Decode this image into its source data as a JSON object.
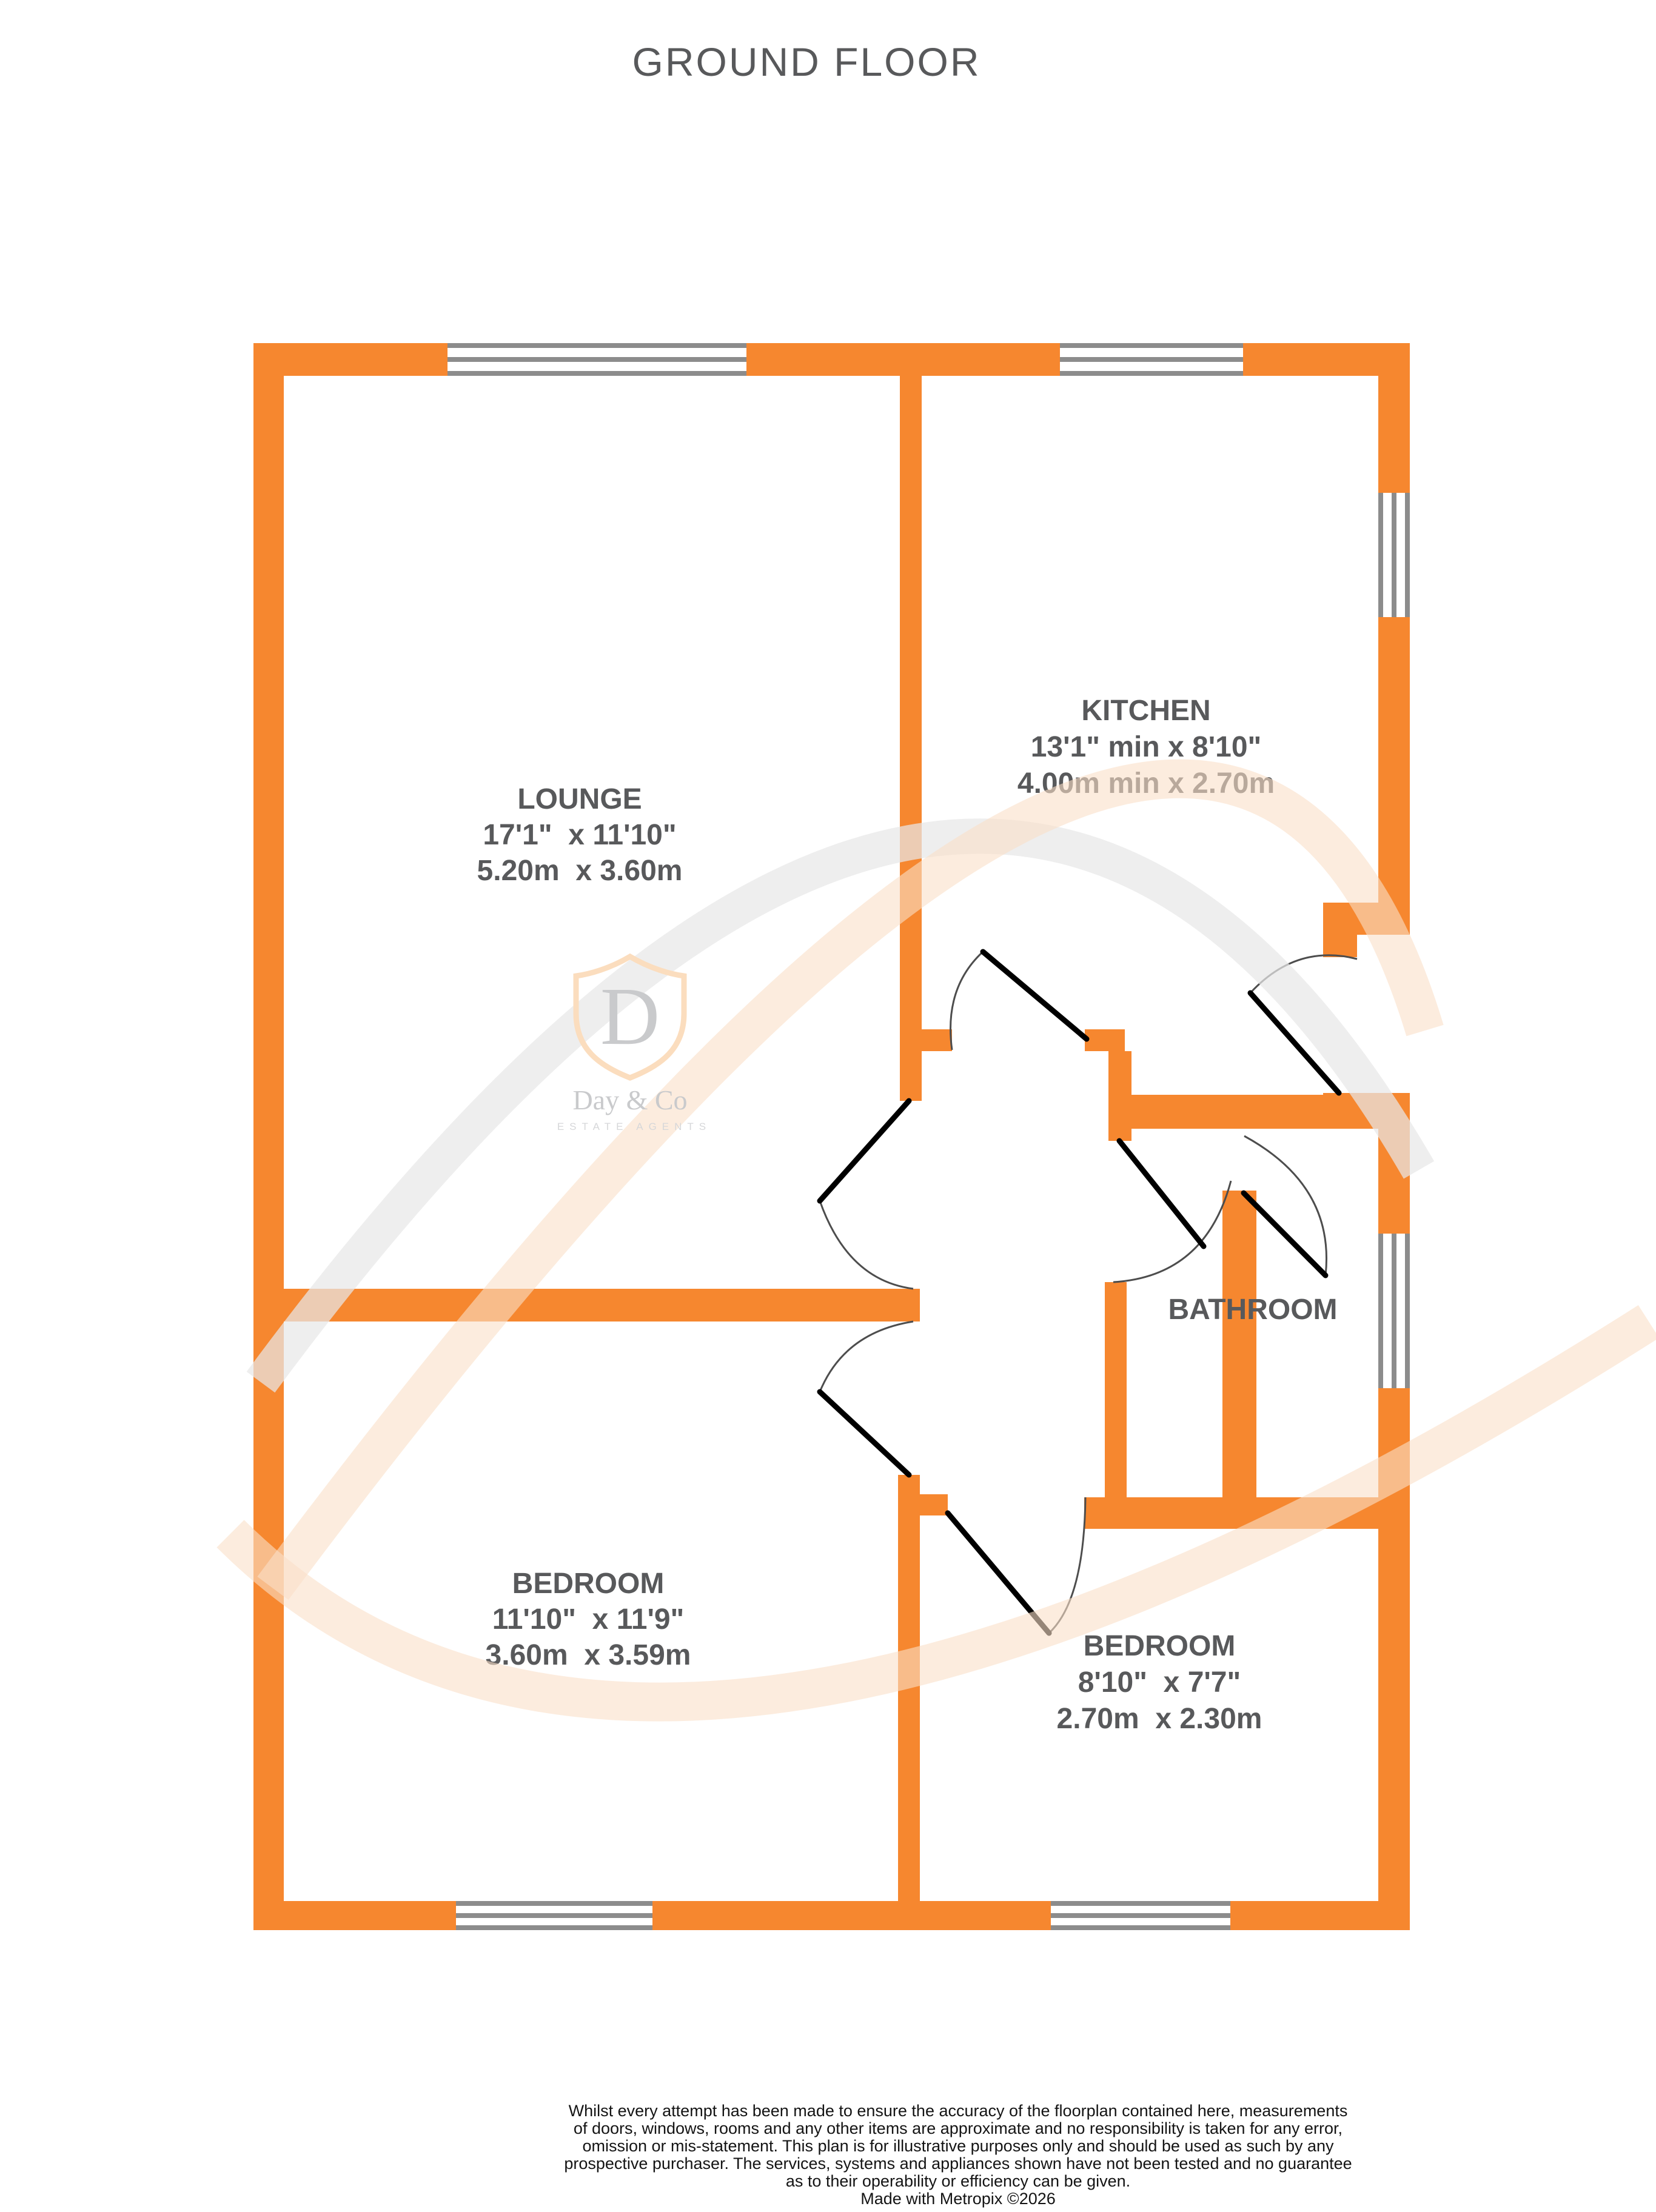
{
  "title": "GROUND FLOOR",
  "floor_plan": {
    "rooms": {
      "lounge": {
        "name": "LOUNGE",
        "imperial": "17'1\"  x 11'10\"",
        "metric": "5.20m  x 3.60m"
      },
      "kitchen": {
        "name": "KITCHEN",
        "imperial": "13'1\" min x 8'10\"",
        "metric": "4.00m min x 2.70m"
      },
      "bathroom": {
        "name": "BATHROOM",
        "imperial": "",
        "metric": ""
      },
      "bedroom1": {
        "name": "BEDROOM",
        "imperial": "11'10\"  x 11'9\"",
        "metric": "3.60m  x 3.59m"
      },
      "bedroom2": {
        "name": "BEDROOM",
        "imperial": "8'10\"  x 7'7\"",
        "metric": "2.70m  x 2.30m"
      }
    },
    "features": {
      "windows": [
        "lounge-front-window",
        "kitchen-front-window",
        "kitchen-side-window",
        "bathroom-side-window",
        "bedroom1-rear-window",
        "bedroom2-rear-window"
      ],
      "doors": [
        "lounge-door",
        "kitchen-door",
        "bedroom1-door",
        "bedroom2-door",
        "bathroom-door",
        "side-entrance-door"
      ]
    }
  },
  "watermark": {
    "initial": "D",
    "name": "Day & Co",
    "tagline": "ESTATE AGENTS"
  },
  "disclaimer": {
    "lines": [
      "Whilst every attempt has been made to ensure the accuracy of the floorplan contained here, measurements",
      "of doors, windows, rooms and any other items are approximate and no responsibility is taken for any error,",
      "omission or mis-statement. This plan is for illustrative purposes only and should be used as such by any",
      "prospective purchaser. The services, systems and appliances shown have not been tested and no guarantee",
      "as to their operability or efficiency can be given.",
      "Made with Metropix ©2026"
    ]
  },
  "colors": {
    "wall": "#F6872F",
    "windowFrame": "#8C8C8C",
    "doorLeaf": "#000000",
    "doorArc": "#4D4D4D",
    "label": "#58595B",
    "title": "#58595B",
    "disclaimer": "#141414",
    "shield": "#FBDDBE",
    "wmText": "#C9CACC",
    "wmTag": "#D6D7D9",
    "swooshOrange": "#FAE0C8",
    "swooshGray": "#E8E8E8"
  }
}
